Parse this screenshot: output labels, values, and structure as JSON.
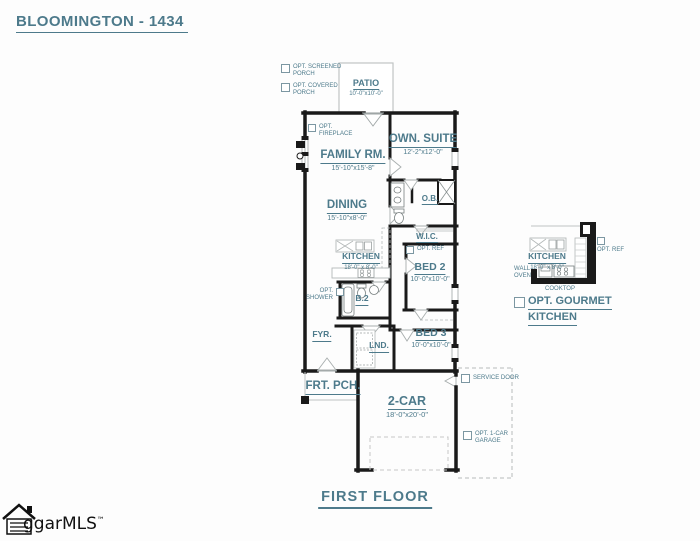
{
  "colors": {
    "accent_text": "#4d7a8b",
    "wall": "#1a1a1a",
    "light_line": "#b5b9b9",
    "background": "#fdfdfd"
  },
  "header": {
    "title": "BLOOMINGTON - 1434"
  },
  "footer": {
    "floor_label": "FIRST FLOOR",
    "logo_text": "ggarMLS",
    "logo_tm": "™"
  },
  "rooms": {
    "patio": {
      "name": "PATIO",
      "dims": "10'-0\"x10'-0\""
    },
    "family_room": {
      "name": "FAMILY RM.",
      "dims": "15'-10\"x15'-8\""
    },
    "owners_suite": {
      "name": "OWN. SUITE",
      "dims": "12'-2\"x12'-0\""
    },
    "dining": {
      "name": "DINING",
      "dims": "15'-10\"x8'-0\""
    },
    "owners_bath": {
      "name": "O.B."
    },
    "walk_in_closet": {
      "name": "W.I.C."
    },
    "kitchen": {
      "name": "KITCHEN",
      "dims": "18'-0\" x 8'-0\""
    },
    "bed2": {
      "name": "BED 2",
      "dims": "10'-0\"x10'-0\""
    },
    "bath2": {
      "name": "B.2"
    },
    "foyer": {
      "name": "FYR."
    },
    "laundry": {
      "name": "LND."
    },
    "bed3": {
      "name": "BED 3",
      "dims": "10'-0\"x10'-0\""
    },
    "front_porch": {
      "name": "FRT. PCH."
    },
    "garage": {
      "name": "2-CAR",
      "dims": "18'-0\"x20'-0\""
    },
    "gourmet_kitchen": {
      "name": "KITCHEN",
      "dims": "18'-0\" x 8'-0\""
    }
  },
  "annotations": {
    "wall_oven_line1": "WALL",
    "wall_oven_line2": "OVEN",
    "cooktop": "COOKTOP"
  },
  "options": {
    "screened_porch": {
      "line1": "OPT. SCREENED",
      "line2": "PORCH"
    },
    "covered_porch": {
      "line1": "OPT. COVERED",
      "line2": "PORCH"
    },
    "fireplace": {
      "line1": "OPT.",
      "line2": "FIREPLACE"
    },
    "shower": {
      "line1": "OPT.",
      "line2": "SHOWER"
    },
    "refrigerator_main": {
      "line1": "OPT. REF"
    },
    "service_door": {
      "line1": "SERVICE DOOR"
    },
    "one_car_garage": {
      "line1": "OPT. 1-CAR",
      "line2": "GARAGE"
    },
    "refrigerator_gourmet": {
      "line1": "OPT. REF"
    },
    "gourmet_kitchen": {
      "line1": "OPT. GOURMET",
      "line2": "KITCHEN"
    }
  }
}
